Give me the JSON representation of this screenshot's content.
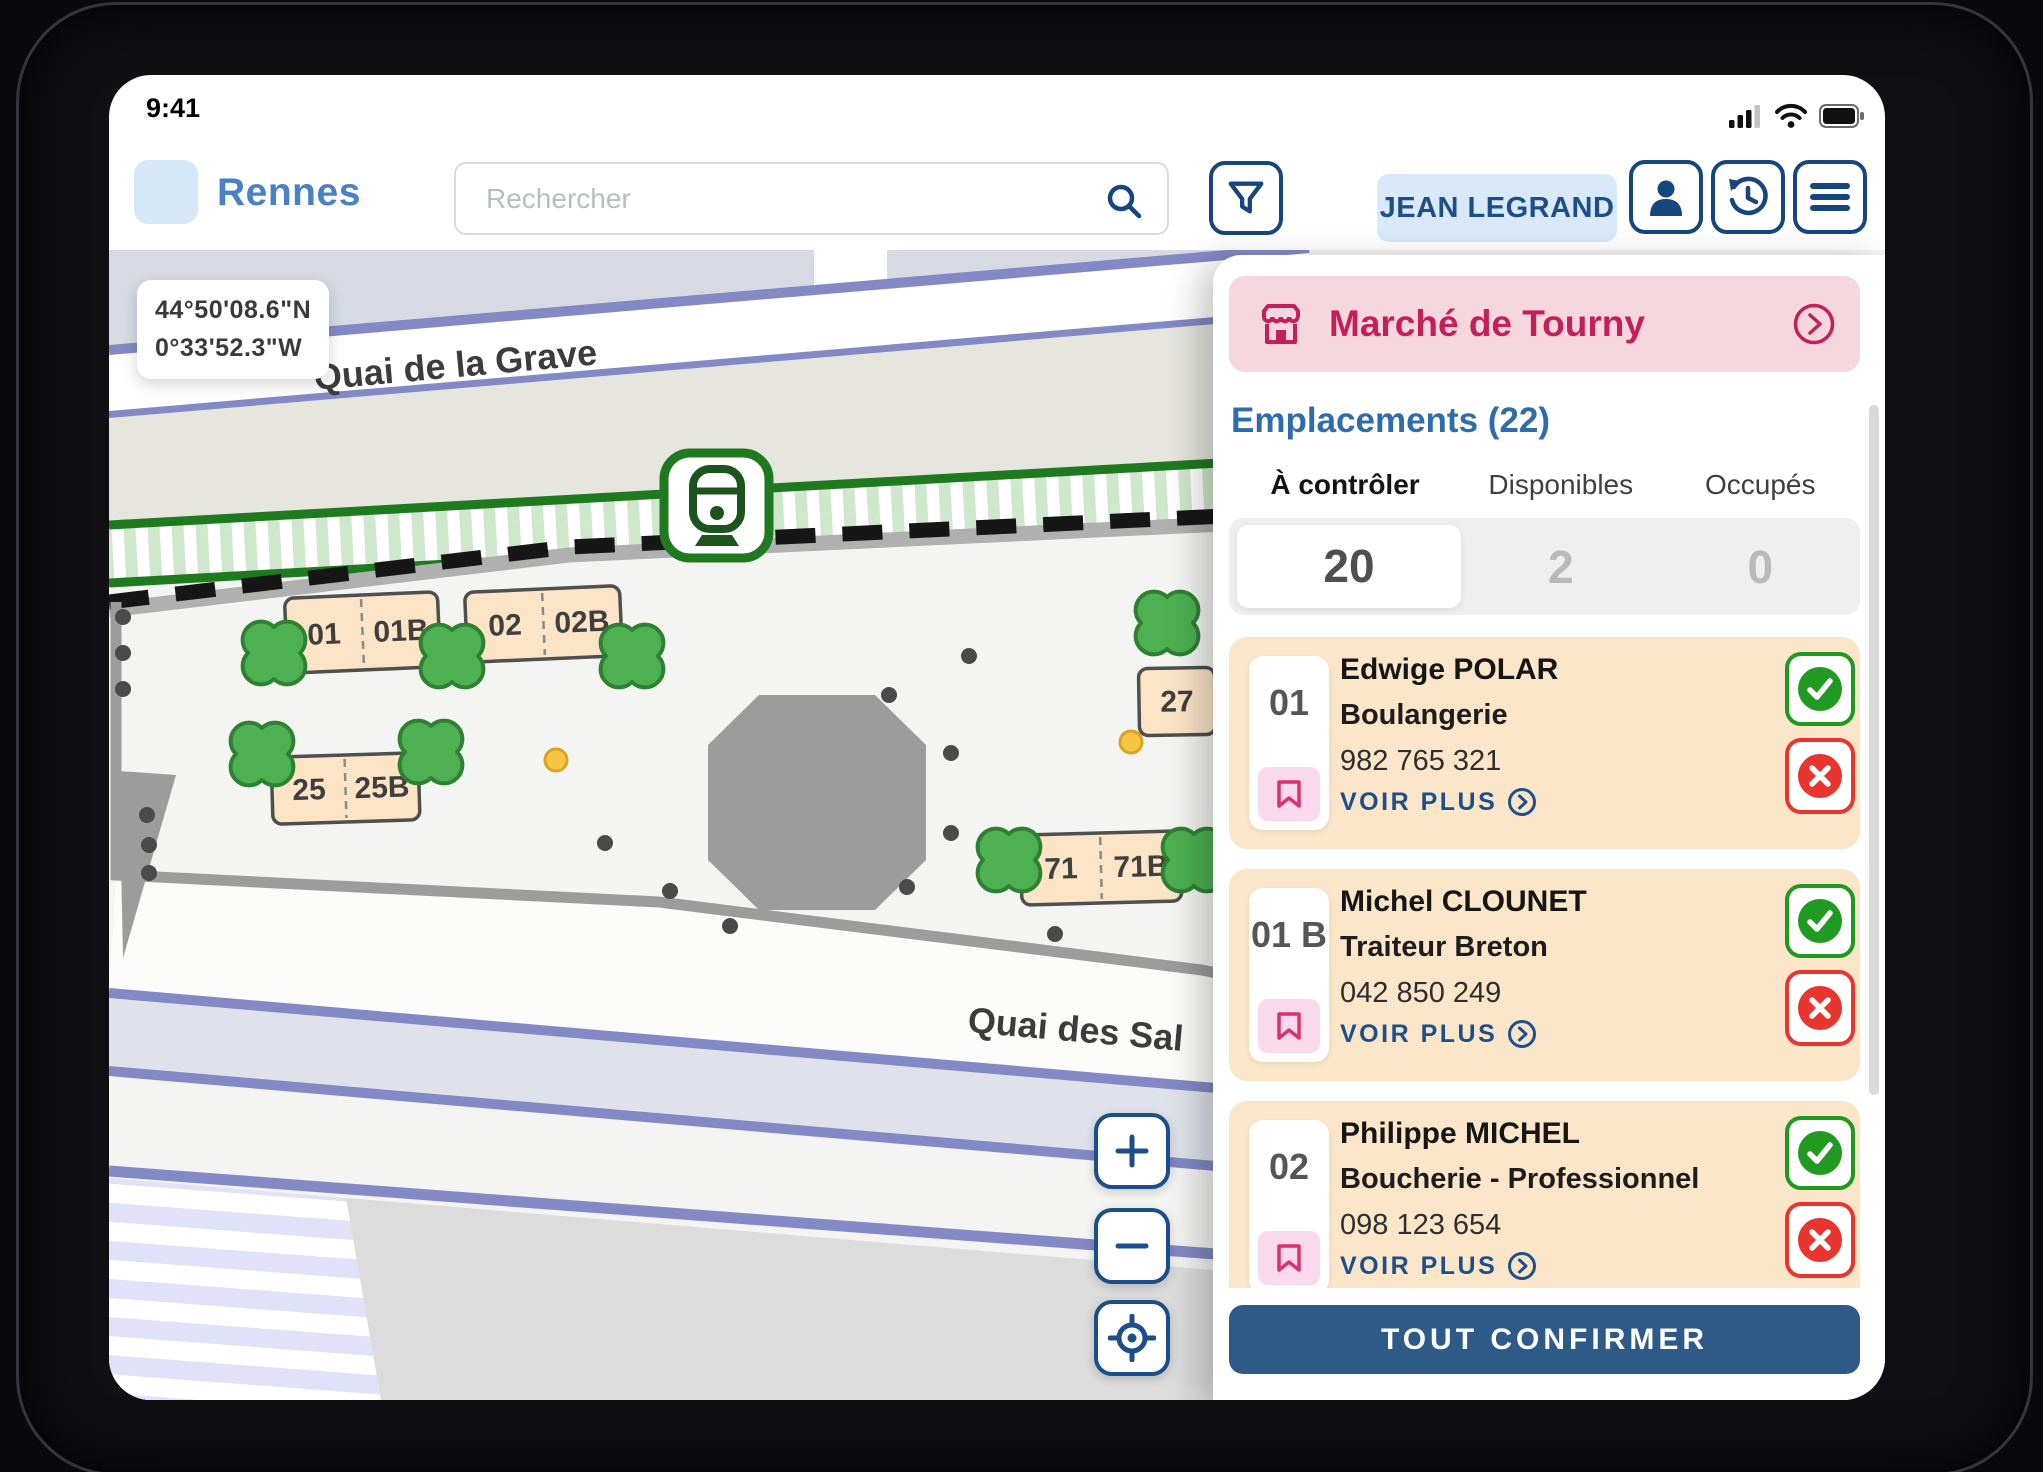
{
  "status_bar": {
    "time": "9:41"
  },
  "header": {
    "city": "Rennes",
    "search": {
      "placeholder": "Rechercher"
    },
    "user": {
      "name": "JEAN LEGRAND"
    }
  },
  "map": {
    "coordinates": {
      "line1": "44°50'08.6\"N",
      "line2": "0°33'52.3\"W"
    },
    "streets": {
      "top": "Quai de la Grave",
      "bottom": "Quai des Sal"
    },
    "stall_labels": [
      "01",
      "01B",
      "02",
      "02B",
      "25",
      "25B",
      "27",
      "71",
      "71B"
    ]
  },
  "panel": {
    "market": {
      "name": "Marché de Tourny"
    },
    "section_title": "Emplacements (22)",
    "tabs": [
      {
        "label": "À contrôler",
        "count": "20"
      },
      {
        "label": "Disponibles",
        "count": "2"
      },
      {
        "label": "Occupés",
        "count": "0"
      }
    ],
    "see_more": "VOIR PLUS",
    "confirm_all": "TOUT CONFIRMER",
    "stalls": [
      {
        "number": "01",
        "name": "Edwige POLAR",
        "activity": "Boulangerie",
        "phone": "982 765 321"
      },
      {
        "number": "01 B",
        "name": "Michel CLOUNET",
        "activity": "Traiteur Breton",
        "phone": "042 850 249"
      },
      {
        "number": "02",
        "name": "Philippe MICHEL",
        "activity": "Boucherie - Professionnel",
        "phone": "098 123 654"
      }
    ]
  },
  "colors": {
    "accent_blue": "#1c4e8a",
    "brand_blue": "#4a80c6",
    "crimson": "#c41f5a",
    "pink_bg": "#f6d7de",
    "card_peach": "#fce6c9",
    "green": "#219a21",
    "red": "#e8352e",
    "confirm_blue": "#2d5a87",
    "tram_green": "#217a21"
  }
}
